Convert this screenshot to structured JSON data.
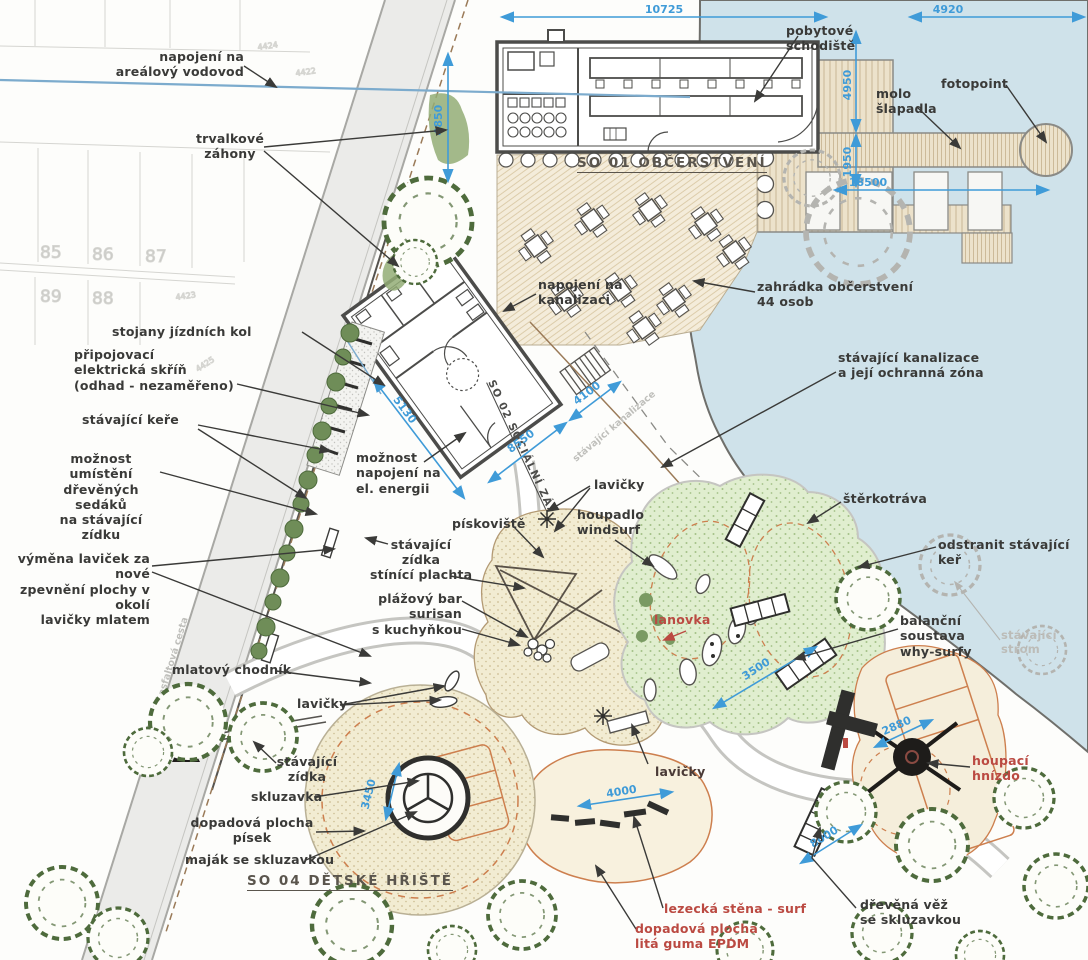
{
  "colors": {
    "water": "#cfe2ea",
    "dim_blue": "#3f9bd8",
    "pipe_blue": "#7cabcd",
    "label_dark": "#3a3a38",
    "label_red": "#bb4a42",
    "label_faint": "#bcbcb8",
    "grass": "#e0eecf",
    "sand": "#f2ecd2",
    "epdm": "#f8f1de",
    "play_border_orange": "#cd7f4e",
    "deck_tan": "#ece2cb",
    "tree_green": "#4e6b3c"
  },
  "plan": {
    "sections": {
      "so01": "SO 01 OBČERSTVENÍ",
      "so02": "SO 02 SOCIÁLNÍ ZÁZEMÍ",
      "so04": "SO 04 DĚTSKÉ HŘIŠTĚ"
    },
    "labels": {
      "vodovod": "napojení na\nareálový vodovod",
      "zahony": "trvalkové\nzáhony",
      "schodiste": "pobytové\nschodiště",
      "molo": "molo\nšlapadla",
      "fotopoint": "fotopoint",
      "zahradka": "zahrádka občerstvení\n44 osob",
      "kanalizace_zona": "stávající kanalizace\na její ochranná zóna",
      "stojany": "stojany jízdních kol",
      "elektro": "připojovací\nelektrická skříň\n(odhad - nezaměřeno)",
      "kere": "stávající keře",
      "sedaky": "možnost umístění\ndřevěných sedáků\nna stávající zídku",
      "vymena": "výměna laviček za nové\nzpevnění plochy v okolí\nlavičky mlatem",
      "nap_kanalizace": "napojení na\nkanalizaci",
      "nap_energie": "možnost\nnapojení na\nel. energii",
      "lavicky_stred": "lavičky",
      "houpadlo": "houpadlo\nwindsurf",
      "piskoviste": "pískoviště",
      "zidka_stred": "stávající\nzídka",
      "plachta": "stínící plachta",
      "bar": "plážový bar\nsurisan\ns kuchyňkou",
      "sterkotrava": "štěrkotráva",
      "odstranit_ker": "odstranit stávající keř",
      "balancni": "balanční soustava\nwhy-surfy",
      "strom": "stávající\nstrom",
      "mlatovy": "mlatový chodník",
      "lavicky_jz": "lavičky",
      "zidka_jz": "stávající\nzídka",
      "skluzavka": "skluzavka",
      "dopad_pisek": "dopadová plocha\npísek",
      "majak": "maják se skluzavkou",
      "lavicky_dole": "lavičky",
      "lanovka": "lanovka",
      "lezecka": "lezecká stěna - surf",
      "dopad_epdm": "dopadová plocha\nlitá guma EPDM",
      "hnizdo": "houpací\nhnízdo",
      "vez": "dřevěná věž\nse skluzavkou",
      "kanalizace_trasa": "stávající kanalizace",
      "cesta": "stávající asfaltová cesta"
    },
    "dimensions": {
      "d10725": "10725",
      "d4920": "4920",
      "d4950": "4950",
      "d1950": "1950",
      "d18500": "18500",
      "d4850": "4850",
      "d5130": "5130",
      "d8550": "8550",
      "d4100": "4100",
      "d3500": "3500",
      "d2880": "2880",
      "d4000": "4000",
      "d3450": "3450",
      "d8000": "8000"
    },
    "parcels": {
      "p85": "85",
      "p86": "86",
      "p87": "87",
      "p88": "88",
      "p89": "89",
      "c1": "4424",
      "c2": "4422",
      "c3": "4425",
      "c4": "4423"
    }
  }
}
